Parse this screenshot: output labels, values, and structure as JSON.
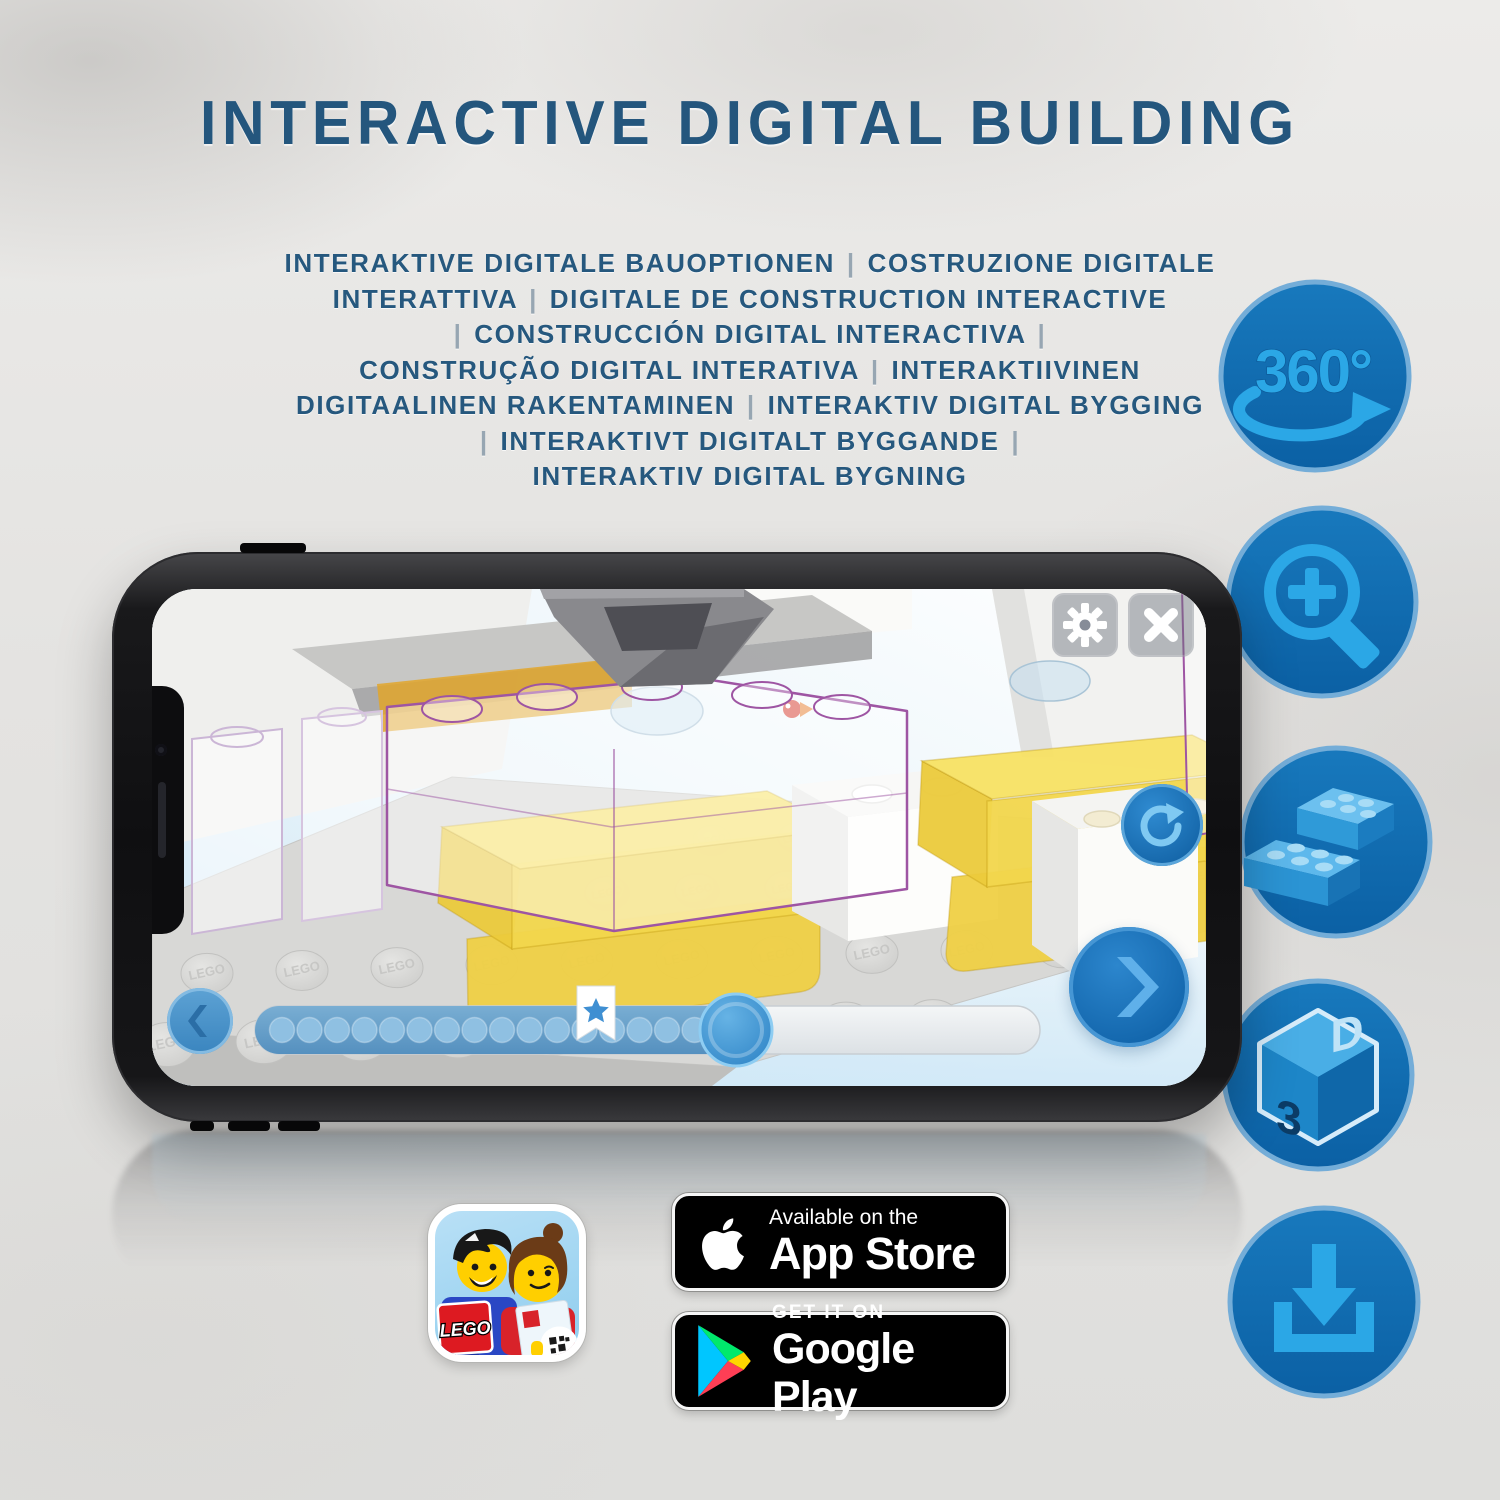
{
  "page": {
    "title": "INTERACTIVE DIGITAL BUILDING",
    "subtitle_lines": [
      "INTERAKTIVE DIGITALE BAUOPTIONEN | COSTRUZIONE DIGITALE",
      "INTERATTIVA | DIGITALE DE CONSTRUCTION INTERACTIVE",
      "| CONSTRUCCIÓN DIGITAL INTERACTIVA |",
      "CONSTRUÇÃO DIGITAL INTERATIVA | INTERAKTIIVINEN",
      "DIGITAALINEN RAKENTAMINEN | INTERAKTIV DIGITAL BYGGING",
      "| INTERAKTIVT DIGITALT BYGGANDE |",
      "INTERAKTIV DIGITAL BYGNING"
    ]
  },
  "features": {
    "rotation_label": "360°",
    "cube_left_label": "3",
    "cube_right_label": "D",
    "items": [
      "360-rotation",
      "zoom-in",
      "brick-stack",
      "3d-view",
      "download"
    ]
  },
  "phone_app": {
    "stud_label": "LEGO"
  },
  "badges": {
    "app_store": {
      "line1": "Available on the",
      "line2": "App Store"
    },
    "google_play": {
      "line1": "GET IT ON",
      "line2": "Google Play"
    },
    "lego_app": {
      "logo_text": "LEGO"
    }
  },
  "colors": {
    "heading_blue": "#24567D",
    "icon_circle_blue": "#0F6CB4",
    "icon_glyph_blue": "#2BA7E6",
    "app_accent_blue": "#1C77C2",
    "ghost_outline_purple": "#9E55A3",
    "brick_yellow": "#F3D74D"
  }
}
